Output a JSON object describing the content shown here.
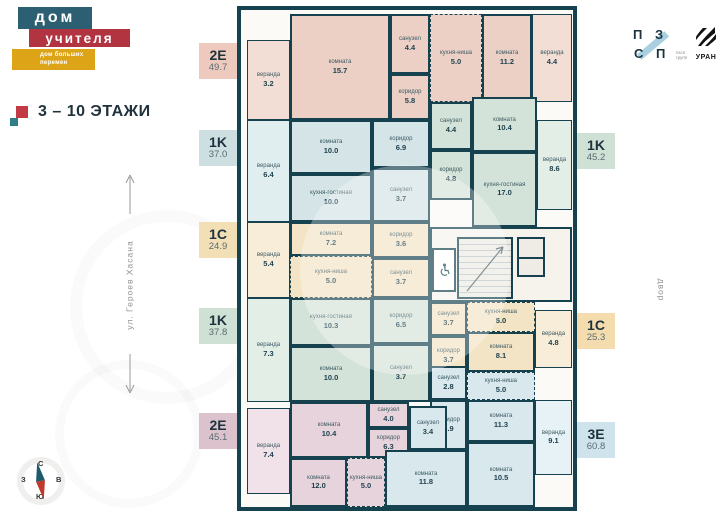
{
  "brand": {
    "top": "дом",
    "middle": "учителя",
    "tagline_line1": "дом больших",
    "tagline_line2": "перемен"
  },
  "floors_label": "3 – 10 ЭТАЖИ",
  "street": "ул. Героев Хасана",
  "yard": "двор",
  "compass": {
    "n": "С",
    "s": "Ю",
    "w": "З",
    "e": "В"
  },
  "logos": {
    "pzsp_letters": [
      "П",
      "З",
      "С",
      "П"
    ],
    "pzsp_sub": [
      "пзсп",
      "групп"
    ],
    "uran": "УРАН"
  },
  "colors": {
    "wall": "#16414f",
    "brand_teal": "#2c5f72",
    "brand_red": "#b23440",
    "brand_yellow": "#dca416"
  },
  "plan": {
    "apartments": [
      {
        "type": "2E",
        "total": "49.7",
        "badge": {
          "side": "left",
          "top": 43,
          "color": "#eecabe"
        },
        "fill": "#ecd0c6",
        "veranda_fill": "#f3ded6",
        "rooms": [
          {
            "name": "веранда",
            "area": "3.2",
            "kind": "veranda",
            "rect": [
              6,
              30,
              43,
              80
            ]
          },
          {
            "name": "комната",
            "area": "15.7",
            "rect": [
              49,
              4,
              100,
              106
            ]
          },
          {
            "name": "санузел",
            "area": "4.4",
            "rect": [
              149,
              4,
              40,
              60
            ]
          },
          {
            "name": "коридор",
            "area": "5.8",
            "rect": [
              149,
              64,
              40,
              46
            ]
          },
          {
            "name": "кухня-ниша",
            "area": "5.0",
            "kind": "niche",
            "rect": [
              189,
              4,
              52,
              88
            ]
          },
          {
            "name": "комната",
            "area": "11.2",
            "rect": [
              241,
              4,
              50,
              88
            ]
          },
          {
            "name": "веранда",
            "area": "4.4",
            "kind": "veranda",
            "rect": [
              291,
              4,
              40,
              88
            ]
          }
        ]
      },
      {
        "type": "1K",
        "total": "37.0",
        "badge": {
          "side": "left",
          "top": 130,
          "color": "#cedfe2"
        },
        "fill": "#d4e4e7",
        "veranda_fill": "#e1eef0",
        "rooms": [
          {
            "name": "веранда",
            "area": "6.4",
            "kind": "veranda",
            "rect": [
              6,
              110,
              43,
              102
            ]
          },
          {
            "name": "комната",
            "area": "10.0",
            "rect": [
              49,
              110,
              82,
              54
            ]
          },
          {
            "name": "кухня-гостиная",
            "area": "10.0",
            "rect": [
              49,
              164,
              82,
              48
            ]
          },
          {
            "name": "коридор",
            "area": "6.9",
            "rect": [
              131,
              110,
              58,
              48
            ]
          },
          {
            "name": "санузел",
            "area": "3.7",
            "rect": [
              131,
              158,
              58,
              54
            ]
          }
        ]
      },
      {
        "type": "1C",
        "total": "24.9",
        "badge": {
          "side": "left",
          "top": 222,
          "color": "#f2dfb6"
        },
        "fill": "#f3e4c5",
        "veranda_fill": "#f8edd8",
        "rooms": [
          {
            "name": "веранда",
            "area": "5.4",
            "kind": "veranda",
            "rect": [
              6,
              212,
              43,
              76
            ]
          },
          {
            "name": "комната",
            "area": "7.2",
            "rect": [
              49,
              212,
              82,
              34
            ]
          },
          {
            "name": "кухня-ниша",
            "area": "5.0",
            "kind": "niche",
            "rect": [
              49,
              246,
              82,
              42
            ]
          },
          {
            "name": "коридор",
            "area": "3.6",
            "rect": [
              131,
              212,
              58,
              36
            ]
          },
          {
            "name": "санузел",
            "area": "3.7",
            "rect": [
              131,
              248,
              58,
              40
            ]
          }
        ]
      },
      {
        "type": "1K",
        "total": "37.8",
        "badge": {
          "side": "left",
          "top": 308,
          "color": "#cfe0d4"
        },
        "fill": "#d4e3d9",
        "veranda_fill": "#e3eee7",
        "rooms": [
          {
            "name": "веранда",
            "area": "7.3",
            "kind": "veranda",
            "rect": [
              6,
              288,
              43,
              104
            ]
          },
          {
            "name": "кухня-гостиная",
            "area": "10.3",
            "rect": [
              49,
              288,
              82,
              48
            ]
          },
          {
            "name": "комната",
            "area": "10.0",
            "rect": [
              49,
              336,
              82,
              56
            ]
          },
          {
            "name": "коридор",
            "area": "6.5",
            "rect": [
              131,
              288,
              58,
              46
            ]
          },
          {
            "name": "санузел",
            "area": "3.7",
            "rect": [
              131,
              334,
              58,
              58
            ]
          }
        ]
      },
      {
        "type": "2E",
        "total": "45.1",
        "badge": {
          "side": "left",
          "top": 413,
          "color": "#dbc2cd"
        },
        "fill": "#e6d3db",
        "veranda_fill": "#f0e2e8",
        "rooms": [
          {
            "name": "веранда",
            "area": "7.4",
            "kind": "veranda",
            "rect": [
              6,
              398,
              43,
              86
            ]
          },
          {
            "name": "комната",
            "area": "10.4",
            "rect": [
              49,
              392,
              78,
              56
            ]
          },
          {
            "name": "санузел",
            "area": "4.0",
            "rect": [
              127,
              392,
              41,
              26
            ]
          },
          {
            "name": "коридор",
            "area": "6.3",
            "rect": [
              127,
              418,
              41,
              30
            ]
          },
          {
            "name": "комната",
            "area": "12.0",
            "rect": [
              49,
              448,
              57,
              49
            ]
          },
          {
            "name": "кухня-ниша",
            "area": "5.0",
            "kind": "niche",
            "rect": [
              106,
              448,
              38,
              49
            ]
          }
        ]
      },
      {
        "type": "1K",
        "total": "45.2",
        "badge": {
          "side": "right",
          "top": 133,
          "color": "#cfe0d4"
        },
        "fill": "#d4e3d9",
        "veranda_fill": "#e3eee7",
        "rooms": [
          {
            "name": "санузел",
            "area": "4.4",
            "rect": [
              189,
              92,
              42,
              48
            ]
          },
          {
            "name": "коридор",
            "area": "4.8",
            "rect": [
              189,
              140,
              42,
              50
            ]
          },
          {
            "name": "комната",
            "area": "10.4",
            "rect": [
              231,
              87,
              65,
              55
            ]
          },
          {
            "name": "кухня-гостиная",
            "area": "17.0",
            "rect": [
              231,
              142,
              65,
              75
            ]
          },
          {
            "name": "веранда",
            "area": "8.6",
            "kind": "veranda",
            "rect": [
              296,
              110,
              35,
              90
            ]
          }
        ]
      },
      {
        "type": "1C",
        "total": "25.3",
        "badge": {
          "side": "right",
          "top": 313,
          "color": "#f4dcae"
        },
        "fill": "#f3e4c5",
        "veranda_fill": "#f8edd8",
        "rooms": [
          {
            "name": "санузел",
            "area": "3.7",
            "rect": [
              189,
              292,
              37,
              34
            ]
          },
          {
            "name": "коридор",
            "area": "3.7",
            "rect": [
              189,
              326,
              37,
              40
            ]
          },
          {
            "name": "кухня-ниша",
            "area": "5.0",
            "kind": "niche",
            "rect": [
              226,
              292,
              68,
              30
            ]
          },
          {
            "name": "комната",
            "area": "8.1",
            "rect": [
              226,
              322,
              68,
              40
            ]
          },
          {
            "name": "веранда",
            "area": "4.8",
            "kind": "veranda",
            "rect": [
              294,
              300,
              37,
              58
            ]
          }
        ]
      },
      {
        "type": "3E",
        "total": "60.8",
        "badge": {
          "side": "right",
          "top": 422,
          "color": "#cfe3ed"
        },
        "fill": "#d8e8ed",
        "veranda_fill": "#e6f2f5",
        "rooms": [
          {
            "name": "санузел",
            "area": "2.8",
            "rect": [
              189,
              356,
              37,
              34
            ]
          },
          {
            "name": "кухня-ниша",
            "area": "5.0",
            "kind": "niche",
            "rect": [
              226,
              362,
              68,
              28
            ]
          },
          {
            "name": "коридор",
            "area": "6.9",
            "rect": [
              189,
              390,
              37,
              50
            ]
          },
          {
            "name": "санузел",
            "area": "3.4",
            "rect": [
              168,
              396,
              38,
              44
            ]
          },
          {
            "name": "комната",
            "area": "11.3",
            "rect": [
              226,
              390,
              68,
              42
            ]
          },
          {
            "name": "комната",
            "area": "10.5",
            "rect": [
              226,
              432,
              68,
              65
            ]
          },
          {
            "name": "комната",
            "area": "11.8",
            "rect": [
              144,
              440,
              82,
              57
            ]
          },
          {
            "name": "веранда",
            "area": "9.1",
            "kind": "veranda",
            "rect": [
              294,
              390,
              37,
              75
            ]
          }
        ]
      }
    ]
  }
}
